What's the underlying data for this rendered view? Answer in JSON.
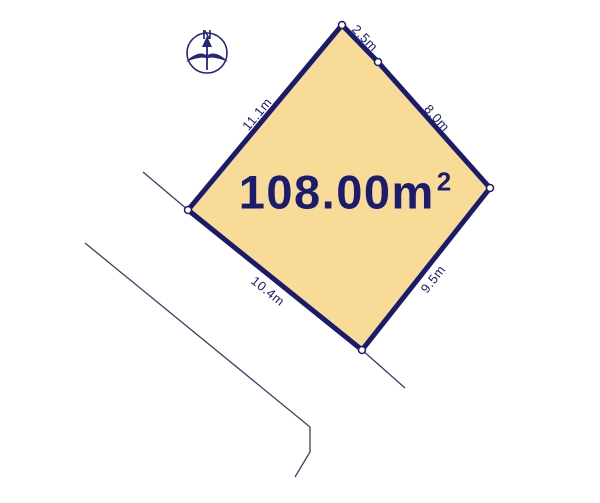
{
  "diagram": {
    "compass": {
      "north_label": "N"
    },
    "plot": {
      "area": {
        "value": "108.00",
        "unit": "m",
        "superscript": "2"
      },
      "edge_labels": {
        "top": "2.5m",
        "upper_right": "8.0m",
        "lower_right": "9.5m",
        "bottom_left": "10.4m",
        "upper_left": "11.1m"
      }
    },
    "colors": {
      "plot_fill": "#f7db97",
      "plot_outline": "#1b1b6e",
      "road_line": "#3b3b66",
      "text": "#1b1b70",
      "background": "#ffffff"
    }
  }
}
